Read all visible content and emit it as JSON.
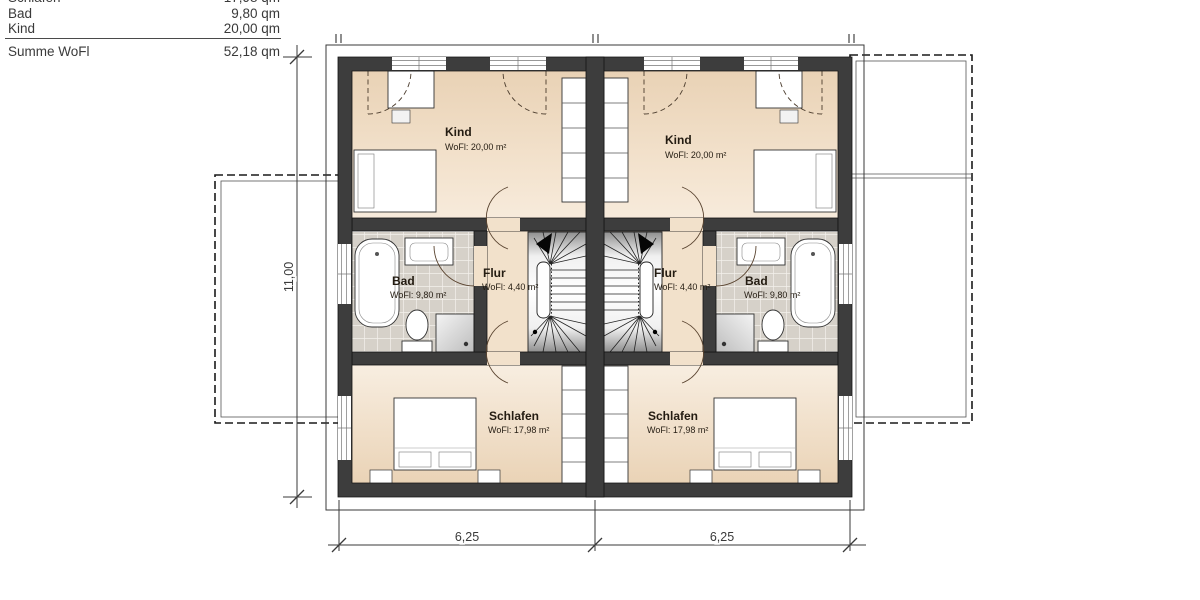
{
  "legend": {
    "rows": [
      {
        "label": "Schlafen",
        "value": "17,98 qm"
      },
      {
        "label": "Bad",
        "value": "9,80 qm"
      },
      {
        "label": "Kind",
        "value": "20,00 qm"
      }
    ],
    "total": {
      "label": "Summe WoFl",
      "value": "52,18 qm"
    }
  },
  "rooms": {
    "left": {
      "kind": {
        "name": "Kind",
        "area": "WoFl: 20,00 m²"
      },
      "bad": {
        "name": "Bad",
        "area": "WoFl: 9,80 m²"
      },
      "flur": {
        "name": "Flur",
        "area": "WoFl: 4,40 m²"
      },
      "schlafen": {
        "name": "Schlafen",
        "area": "WoFl: 17,98 m²"
      }
    },
    "right": {
      "kind": {
        "name": "Kind",
        "area": "WoFl: 20,00 m²"
      },
      "bad": {
        "name": "Bad",
        "area": "WoFl: 9,80 m²"
      },
      "flur": {
        "name": "Flur",
        "area": "WoFl: 4,40 m²"
      },
      "schlafen": {
        "name": "Schlafen",
        "area": "WoFl: 17,98 m²"
      }
    }
  },
  "dimensions": {
    "side": "11,00",
    "bottom_left": "6,25",
    "bottom_right": "6,25"
  },
  "colors": {
    "wall": "#3d3d3d",
    "floor": "#f1dfc8",
    "tile": "#d6d1c9",
    "line": "#3a3a3a"
  }
}
